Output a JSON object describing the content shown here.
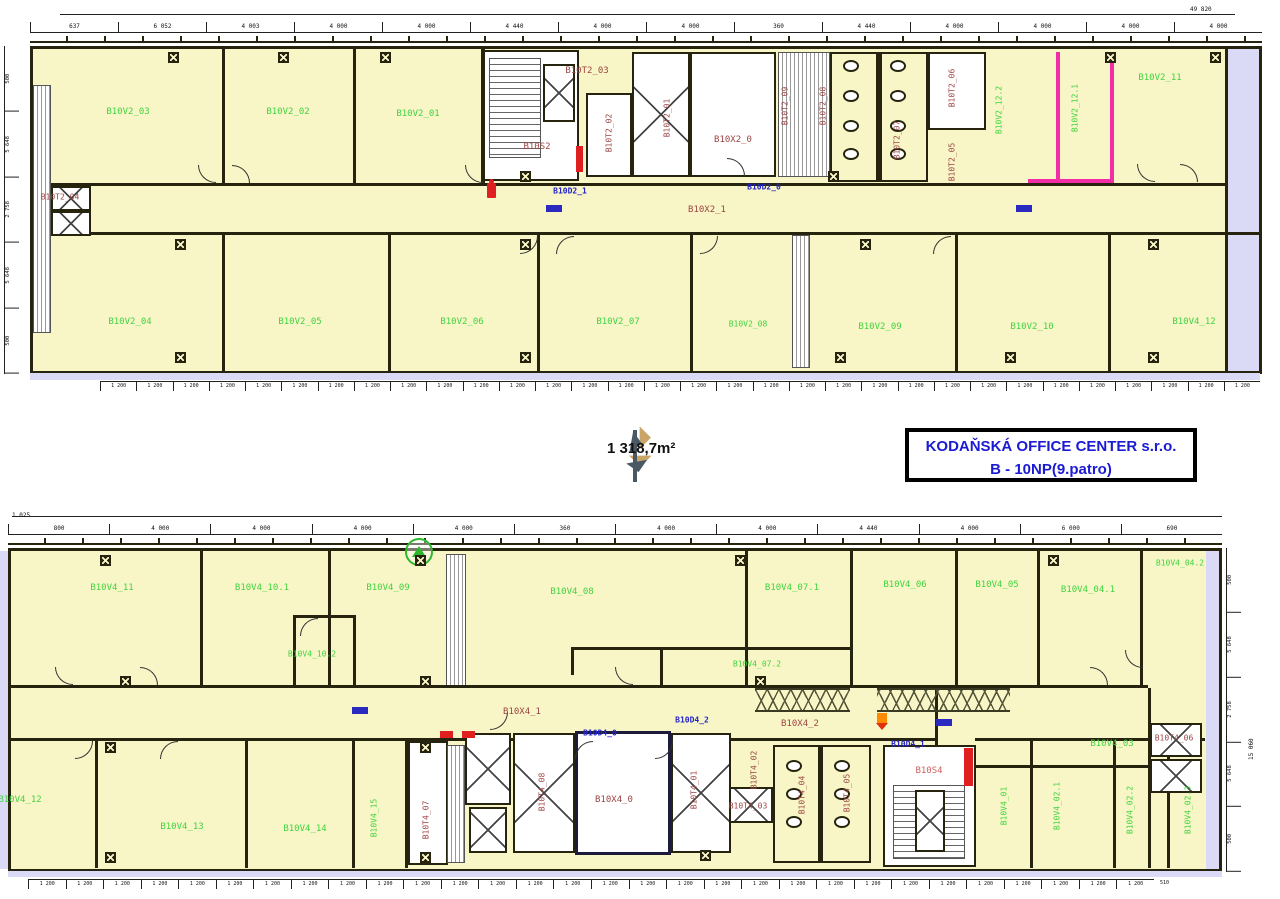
{
  "title_block": {
    "company": "KODAŇSKÁ OFFICE CENTER s.r.o.",
    "floor": "B - 10NP(9.patro)"
  },
  "area_label": "1 318,7m²",
  "top_plan": {
    "rooms": {
      "v2_01": "B10V2_01",
      "v2_02": "B10V2_02",
      "v2_03": "B10V2_03",
      "v2_04": "B10V2_04",
      "v2_05": "B10V2_05",
      "v2_06": "B10V2_06",
      "v2_07": "B10V2_07",
      "v2_08": "B10V2_08",
      "v2_09": "B10V2_09",
      "v2_10": "B10V2_10",
      "v2_11": "B10V2_11",
      "v2_12_1": "B10V2_12.1",
      "v2_12_2": "B10V2_12.2",
      "v4_12r": "B10V4_12"
    },
    "core": {
      "s2": "B10S2",
      "x2_0": "B10X2_0",
      "x2_1": "B10X2_1",
      "t2_01": "B10T2_01",
      "t2_02": "B10T2_02",
      "t2_03": "B10T2_03",
      "t2_04": "B10T2_04",
      "t2_05": "B10T2_05",
      "t2_06": "B10T2_06",
      "t2_07": "B10T2_07",
      "t2_08": "B10T2_08",
      "t2_09": "B10T2_09",
      "d2_0": "B10D2_0",
      "d2_1": "B10D2_1"
    }
  },
  "bottom_plan": {
    "rooms": {
      "v4_01": "B10V4_01",
      "v4_02_1": "B10V4_02.1",
      "v4_02_2": "B10V4_02.2",
      "v4_02_3": "B10V4_02.3",
      "v4_03": "B10V4_03",
      "v4_04_1": "B10V4_04.1",
      "v4_04_2": "B10V4_04.2",
      "v4_05": "B10V4_05",
      "v4_06": "B10V4_06",
      "v4_07_1": "B10V4_07.1",
      "v4_07_2": "B10V4_07.2",
      "v4_08": "B10V4_08",
      "v4_09": "B10V4_09",
      "v4_10_1": "B10V4_10.1",
      "v4_10_2": "B10V4_10.2",
      "v4_11": "B10V4_11",
      "v4_12": "B10V4_12",
      "v4_13": "B10V4_13",
      "v4_14": "B10V4_14",
      "v4_15": "B10V4_15"
    },
    "core": {
      "s4": "B10S4",
      "x4_0": "B10X4_0",
      "x4_1": "B10X4_1",
      "x4_2": "B10X4_2",
      "t4_01": "B10T4_01",
      "t4_02": "B10T4_02",
      "t4_03": "B10T4_03",
      "t4_04": "B10T4_04",
      "t4_05": "B10T4_05",
      "t4_06": "B10T4_06",
      "t4_07": "B10T4_07",
      "t4_08": "B10T4_08",
      "d4_0": "B10D4_0",
      "d4_1": "B10D4_1",
      "d4_2": "B10D4_2"
    }
  },
  "dimensions": {
    "top_overall": "49 820",
    "top_segments": [
      "637",
      "6 052",
      "4 003",
      "4 000",
      "4 000",
      "4 440",
      "4 000",
      "4 000",
      "360",
      "4 440",
      "4 000",
      "4 000",
      "4 000",
      "4 000"
    ],
    "bottom_overall_left": "1 025",
    "bottom_segments": [
      "800",
      "4 000",
      "4 000",
      "4 000",
      "4 000",
      "360",
      "4 000",
      "4 000",
      "4 440",
      "4 000",
      "6 000",
      "690"
    ],
    "module": "1 200",
    "module_end": "510",
    "left_side": [
      "500",
      "5 648",
      "2 758",
      "5 648",
      "500"
    ],
    "right_side": [
      "500",
      "5 648",
      "2 758",
      "5 648",
      "500"
    ],
    "right_overall": "15 060"
  },
  "icons": {
    "north_arrow": "green-circle-triangle",
    "hydrant": "red-hydrant-marker",
    "fire_hose": "red-bar",
    "door_mat": "blue-mat",
    "orange_marker": "orange-valve",
    "sensor": "boxed-x"
  },
  "colors": {
    "room_fill": "#f8f6c6",
    "wall": "#26240e",
    "label_green": "#3fd43f",
    "label_maroon": "#9c4444",
    "label_blue": "#2323cc",
    "title_blue": "#1b1bd3",
    "pink": "#f32da6",
    "lavender": "#dadaf6",
    "red": "#e02020",
    "orange": "#ff8a00",
    "logo_gold": "#c9a668",
    "logo_slate": "#4a5863"
  }
}
